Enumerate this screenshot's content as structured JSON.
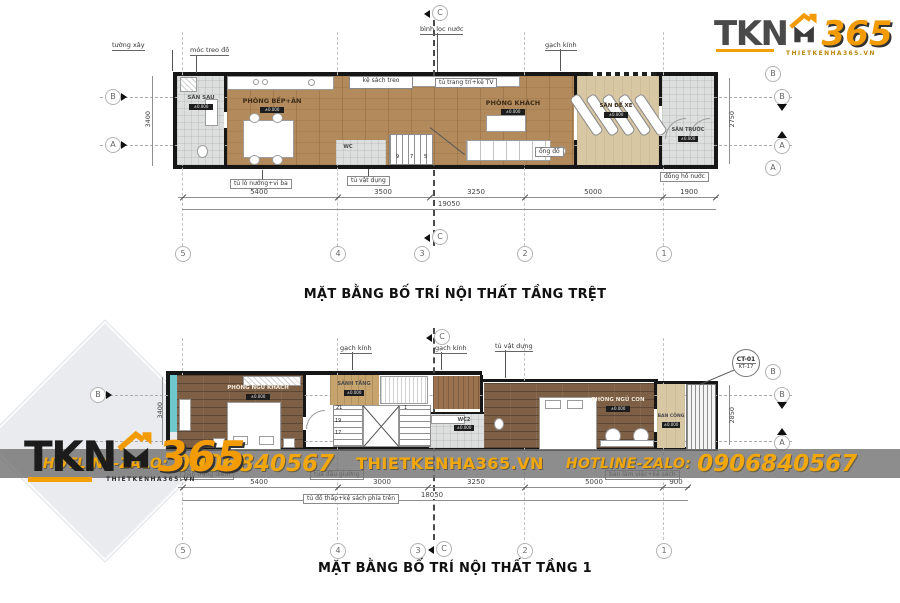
{
  "brand": {
    "tkn": "TKN",
    "n365": "365",
    "site": "THIETKENHA365.VN"
  },
  "banner": {
    "h1": "HOTLINE-ZALO:",
    "p1": "0906840567",
    "site": "THIETKENHA365.VN",
    "h2": "HOTLINE-ZALO:",
    "p2": "0906840567",
    "accent": "#f2a70d"
  },
  "plan1": {
    "title": "MẶT BẰNG BỐ TRÍ NỘI THẤT TẦNG TRỆT",
    "rooms": {
      "san_sau": {
        "name": "SÂN SAU",
        "level": "±0.000"
      },
      "bep_an": {
        "name": "PHÒNG BẾP+ĂN",
        "level": "±0.000"
      },
      "wc": {
        "name": "WC"
      },
      "khach": {
        "name": "PHÒNG KHÁCH",
        "level": "±0.000"
      },
      "de_xe": {
        "name": "SÂN ĐỂ XE",
        "level": "±0.000"
      },
      "san_truoc": {
        "name": "SÂN TRƯỚC",
        "level": "±0.000"
      }
    },
    "notes": {
      "tuong_xay": "tường xây",
      "moc_treo": "móc treo đồ",
      "ke_sach": "kệ sách treo",
      "binh_loc": "bình lọc nước",
      "tu_tv": "tủ trang trí+kệ TV",
      "gach_kinh": "gạch kính",
      "tu_lo": "tủ lò nướng+vi ba",
      "tu_vat_dung": "tủ vật dụng",
      "dong_ho": "đồng hồ nước",
      "ong_do": "ống đổ"
    },
    "stairs": [
      "9",
      "7",
      "5"
    ],
    "dims": [
      "5400",
      "3500",
      "3250",
      "5000",
      "1900"
    ],
    "total": "19050",
    "dim_left": "3400",
    "dim_right": "2750",
    "grid_cols": [
      "5",
      "4",
      "3",
      "2",
      "1"
    ],
    "grid_b": "B",
    "grid_a": "A",
    "section": "C"
  },
  "plan2": {
    "title": "MẶT BẰNG BỐ TRÍ NỘI THẤT TẦNG 1",
    "rooms": {
      "ngu_khach": {
        "name": "PHÒNG NGỦ KHÁCH",
        "level": "±0.000"
      },
      "sanh": {
        "name": "SẢNH TẦNG",
        "level": "±0.000"
      },
      "wc2": {
        "name": "WC2",
        "level": "±0.000"
      },
      "ngu_con": {
        "name": "PHÒNG NGỦ CON",
        "level": "±0.000"
      },
      "ban_cong": {
        "name": "BAN CÔNG",
        "level": "±0.000"
      }
    },
    "notes": {
      "gach_kinh1": "gạch kính",
      "gach_kinh2": "gạch kính",
      "tu_vat_dung": "tủ vật dụng",
      "ban_trang_diem": "bàn trang điểm",
      "tua_dau_giuong": "tựa đầu giường",
      "tu_do_thap": "tủ đồ thấp+kệ sách phía trên",
      "ban_lam_viec": "bàn làm việc+kệ sách"
    },
    "callout": {
      "top": "CT-01",
      "bottom": "KT-17"
    },
    "stairs": [
      "21",
      "19",
      "17",
      "1"
    ],
    "dims": [
      "5400",
      "3000",
      "3250",
      "5000",
      "900"
    ],
    "total": "18050",
    "dim_left": "3400",
    "dim_right": "2850",
    "grid_cols": [
      "5",
      "4",
      "3",
      "2",
      "1"
    ],
    "grid_b": "B",
    "grid_a": "A",
    "section": "C"
  }
}
